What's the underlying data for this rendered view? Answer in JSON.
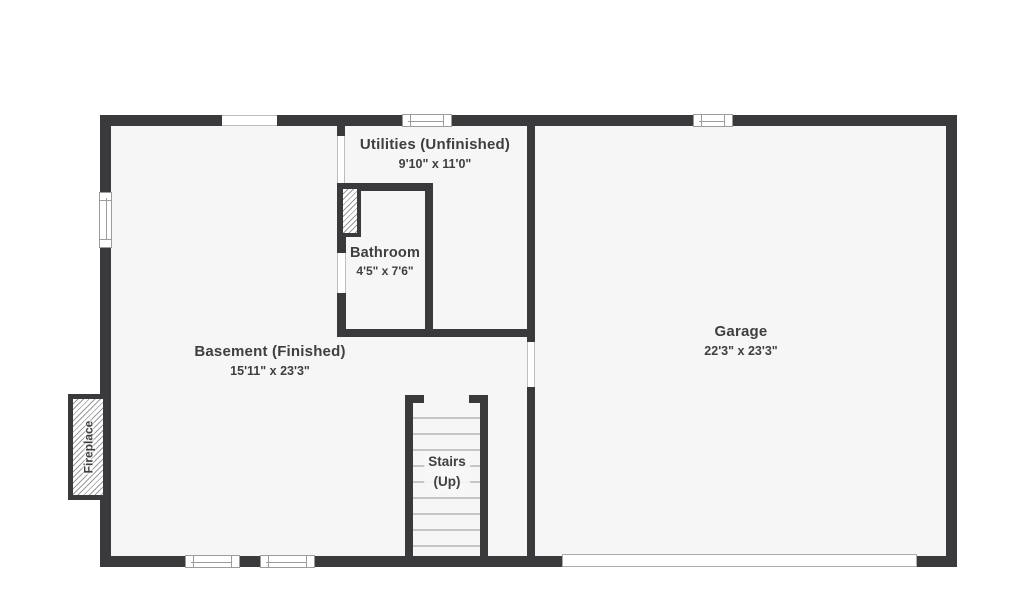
{
  "floorplan": {
    "title": "Basement level floor plan",
    "colors": {
      "wall": "#3a3a3c",
      "floor": "#f6f6f6",
      "background": "#ffffff",
      "text": "#3f3f42",
      "tread_line": "#c6c6c6"
    },
    "rooms": {
      "utilities": {
        "name": "Utilities (Unfinished)",
        "dims": "9'10\" x 11'0\""
      },
      "bathroom": {
        "name": "Bathroom",
        "dims": "4'5\" x 7'6\""
      },
      "garage": {
        "name": "Garage",
        "dims": "22'3\" x 23'3\""
      },
      "basement": {
        "name": "Basement (Finished)",
        "dims": "15'11\" x 23'3\""
      },
      "stairs": {
        "name": "Stairs",
        "direction": "(Up)"
      },
      "fireplace": {
        "name": "Fireplace"
      }
    }
  }
}
